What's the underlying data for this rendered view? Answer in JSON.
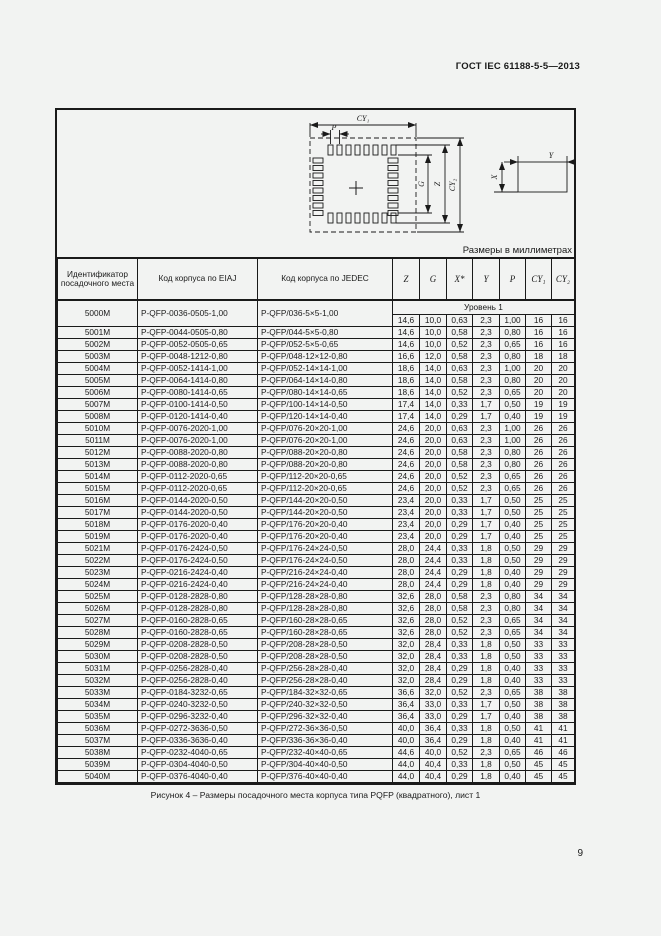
{
  "page": {
    "header": "ГОСТ IEC 61188-5-5—2013",
    "units_note": "Размеры в миллиметрах",
    "caption": "Рисунок 4 – Размеры посадочного места корпуса типа PQFP (квадратного), лист 1",
    "page_number": "9"
  },
  "diagram": {
    "labels": {
      "cy1": "CY₁",
      "p": "P",
      "g": "G",
      "z": "Z",
      "cy2": "CY₂",
      "x": "X",
      "y": "Y"
    }
  },
  "table": {
    "headers": [
      "Идентификатор посадочного места",
      "Код корпуса по EIAJ",
      "Код корпуса по JEDEC",
      "Z",
      "G",
      "X*",
      "Y",
      "P",
      "CY₁",
      "CY₂"
    ],
    "level_label": "Уровень 1",
    "rows": [
      [
        "5000M",
        "P-QFP-0036-0505-1,00",
        "P-QFP/036-5×5-1,00",
        "14,6",
        "10,0",
        "0,63",
        "2,3",
        "1,00",
        "16",
        "16"
      ],
      [
        "5001M",
        "P-QFP-0044-0505-0,80",
        "P-QFP/044-5×5-0,80",
        "14,6",
        "10,0",
        "0,58",
        "2,3",
        "0,80",
        "16",
        "16"
      ],
      [
        "5002M",
        "P-QFP-0052-0505-0,65",
        "P-QFP/052-5×5-0,65",
        "14,6",
        "10,0",
        "0,52",
        "2,3",
        "0,65",
        "16",
        "16"
      ],
      [
        "5003M",
        "P-QFP-0048-1212-0,80",
        "P-QFP/048-12×12-0,80",
        "16,6",
        "12,0",
        "0,58",
        "2,3",
        "0,80",
        "18",
        "18"
      ],
      [
        "5004M",
        "P-QFP-0052-1414-1,00",
        "P-QFP/052-14×14-1,00",
        "18,6",
        "14,0",
        "0,63",
        "2,3",
        "1,00",
        "20",
        "20"
      ],
      [
        "5005M",
        "P-QFP-0064-1414-0,80",
        "P-QFP/064-14×14-0,80",
        "18,6",
        "14,0",
        "0,58",
        "2,3",
        "0,80",
        "20",
        "20"
      ],
      [
        "5006M",
        "P-QFP-0080-1414-0,65",
        "P-QFP/080-14×14-0,65",
        "18,6",
        "14,0",
        "0,52",
        "2,3",
        "0,65",
        "20",
        "20"
      ],
      [
        "5007M",
        "P-QFP-0100-1414-0,50",
        "P-QFP/100-14×14-0,50",
        "17,4",
        "14,0",
        "0,33",
        "1,7",
        "0,50",
        "19",
        "19"
      ],
      [
        "5008M",
        "P-QFP-0120-1414-0,40",
        "P-QFP/120-14×14-0,40",
        "17,4",
        "14,0",
        "0,29",
        "1,7",
        "0,40",
        "19",
        "19"
      ],
      [
        "5010M",
        "P-QFP-0076-2020-1,00",
        "P-QFP/076-20×20-1,00",
        "24,6",
        "20,0",
        "0,63",
        "2,3",
        "1,00",
        "26",
        "26"
      ],
      [
        "5011M",
        "P-QFP-0076-2020-1,00",
        "P-QFP/076-20×20-1,00",
        "24,6",
        "20,0",
        "0,63",
        "2,3",
        "1,00",
        "26",
        "26"
      ],
      [
        "5012M",
        "P-QFP-0088-2020-0,80",
        "P-QFP/088-20×20-0,80",
        "24,6",
        "20,0",
        "0,58",
        "2,3",
        "0,80",
        "26",
        "26"
      ],
      [
        "5013M",
        "P-QFP-0088-2020-0,80",
        "P-QFP/088-20×20-0,80",
        "24,6",
        "20,0",
        "0,58",
        "2,3",
        "0,80",
        "26",
        "26"
      ],
      [
        "5014M",
        "P-QFP-0112-2020-0,65",
        "P-QFP/112-20×20-0,65",
        "24,6",
        "20,0",
        "0,52",
        "2,3",
        "0,65",
        "26",
        "26"
      ],
      [
        "5015M",
        "P-QFP-0112-2020-0,65",
        "P-QFP/112-20×20-0,65",
        "24,6",
        "20,0",
        "0,52",
        "2,3",
        "0,65",
        "26",
        "26"
      ],
      [
        "5016M",
        "P-QFP-0144-2020-0,50",
        "P-QFP/144-20×20-0,50",
        "23,4",
        "20,0",
        "0,33",
        "1,7",
        "0,50",
        "25",
        "25"
      ],
      [
        "5017M",
        "P-QFP-0144-2020-0,50",
        "P-QFP/144-20×20-0,50",
        "23,4",
        "20,0",
        "0,33",
        "1,7",
        "0,50",
        "25",
        "25"
      ],
      [
        "5018M",
        "P-QFP-0176-2020-0,40",
        "P-QFP/176-20×20-0,40",
        "23,4",
        "20,0",
        "0,29",
        "1,7",
        "0,40",
        "25",
        "25"
      ],
      [
        "5019M",
        "P-QFP-0176-2020-0,40",
        "P-QFP/176-20×20-0,40",
        "23,4",
        "20,0",
        "0,29",
        "1,7",
        "0,40",
        "25",
        "25"
      ],
      [
        "5021M",
        "P-QFP-0176-2424-0,50",
        "P-QFP/176-24×24-0,50",
        "28,0",
        "24,4",
        "0,33",
        "1,8",
        "0,50",
        "29",
        "29"
      ],
      [
        "5022M",
        "P-QFP-0176-2424-0,50",
        "P-QFP/176-24×24-0,50",
        "28,0",
        "24,4",
        "0,33",
        "1,8",
        "0,50",
        "29",
        "29"
      ],
      [
        "5023M",
        "P-QFP-0216-2424-0,40",
        "P-QFP/216-24×24-0,40",
        "28,0",
        "24,4",
        "0,29",
        "1,8",
        "0,40",
        "29",
        "29"
      ],
      [
        "5024M",
        "P-QFP-0216-2424-0,40",
        "P-QFP/216-24×24-0,40",
        "28,0",
        "24,4",
        "0,29",
        "1,8",
        "0,40",
        "29",
        "29"
      ],
      [
        "5025M",
        "P-QFP-0128-2828-0,80",
        "P-QFP/128-28×28-0,80",
        "32,6",
        "28,0",
        "0,58",
        "2,3",
        "0,80",
        "34",
        "34"
      ],
      [
        "5026M",
        "P-QFP-0128-2828-0,80",
        "P-QFP/128-28×28-0,80",
        "32,6",
        "28,0",
        "0,58",
        "2,3",
        "0,80",
        "34",
        "34"
      ],
      [
        "5027M",
        "P-QFP-0160-2828-0,65",
        "P-QFP/160-28×28-0,65",
        "32,6",
        "28,0",
        "0,52",
        "2,3",
        "0,65",
        "34",
        "34"
      ],
      [
        "5028M",
        "P-QFP-0160-2828-0,65",
        "P-QFP/160-28×28-0,65",
        "32,6",
        "28,0",
        "0,52",
        "2,3",
        "0,65",
        "34",
        "34"
      ],
      [
        "5029M",
        "P-QFP-0208-2828-0,50",
        "P-QFP/208-28×28-0,50",
        "32,0",
        "28,4",
        "0,33",
        "1,8",
        "0,50",
        "33",
        "33"
      ],
      [
        "5030M",
        "P-QFP-0208-2828-0,50",
        "P-QFP/208-28×28-0,50",
        "32,0",
        "28,4",
        "0,33",
        "1,8",
        "0,50",
        "33",
        "33"
      ],
      [
        "5031M",
        "P-QFP-0256-2828-0,40",
        "P-QFP/256-28×28-0,40",
        "32,0",
        "28,4",
        "0,29",
        "1,8",
        "0,40",
        "33",
        "33"
      ],
      [
        "5032M",
        "P-QFP-0256-2828-0,40",
        "P-QFP/256-28×28-0,40",
        "32,0",
        "28,4",
        "0,29",
        "1,8",
        "0,40",
        "33",
        "33"
      ],
      [
        "5033M",
        "P-QFP-0184-3232-0,65",
        "P-QFP/184-32×32-0,65",
        "36,6",
        "32,0",
        "0,52",
        "2,3",
        "0,65",
        "38",
        "38"
      ],
      [
        "5034M",
        "P-QFP-0240-3232-0,50",
        "P-QFP/240-32×32-0,50",
        "36,4",
        "33,0",
        "0,33",
        "1,7",
        "0,50",
        "38",
        "38"
      ],
      [
        "5035M",
        "P-QFP-0296-3232-0,40",
        "P-QFP/296-32×32-0,40",
        "36,4",
        "33,0",
        "0,29",
        "1,7",
        "0,40",
        "38",
        "38"
      ],
      [
        "5036M",
        "P-QFP-0272-3636-0,50",
        "P-QFP/272-36×36-0,50",
        "40,0",
        "36,4",
        "0,33",
        "1,8",
        "0,50",
        "41",
        "41"
      ],
      [
        "5037M",
        "P-QFP-0336-3636-0,40",
        "P-QFP/336-36×36-0,40",
        "40,0",
        "36,4",
        "0,29",
        "1,8",
        "0,40",
        "41",
        "41"
      ],
      [
        "5038M",
        "P-QFP-0232-4040-0,65",
        "P-QFP/232-40×40-0,65",
        "44,6",
        "40,0",
        "0,52",
        "2,3",
        "0,65",
        "46",
        "46"
      ],
      [
        "5039M",
        "P-QFP-0304-4040-0,50",
        "P-QFP/304-40×40-0,50",
        "44,0",
        "40,4",
        "0,33",
        "1,8",
        "0,50",
        "45",
        "45"
      ],
      [
        "5040M",
        "P-QFP-0376-4040-0,40",
        "P-QFP/376-40×40-0,40",
        "44,0",
        "40,4",
        "0,29",
        "1,8",
        "0,40",
        "45",
        "45"
      ]
    ]
  }
}
